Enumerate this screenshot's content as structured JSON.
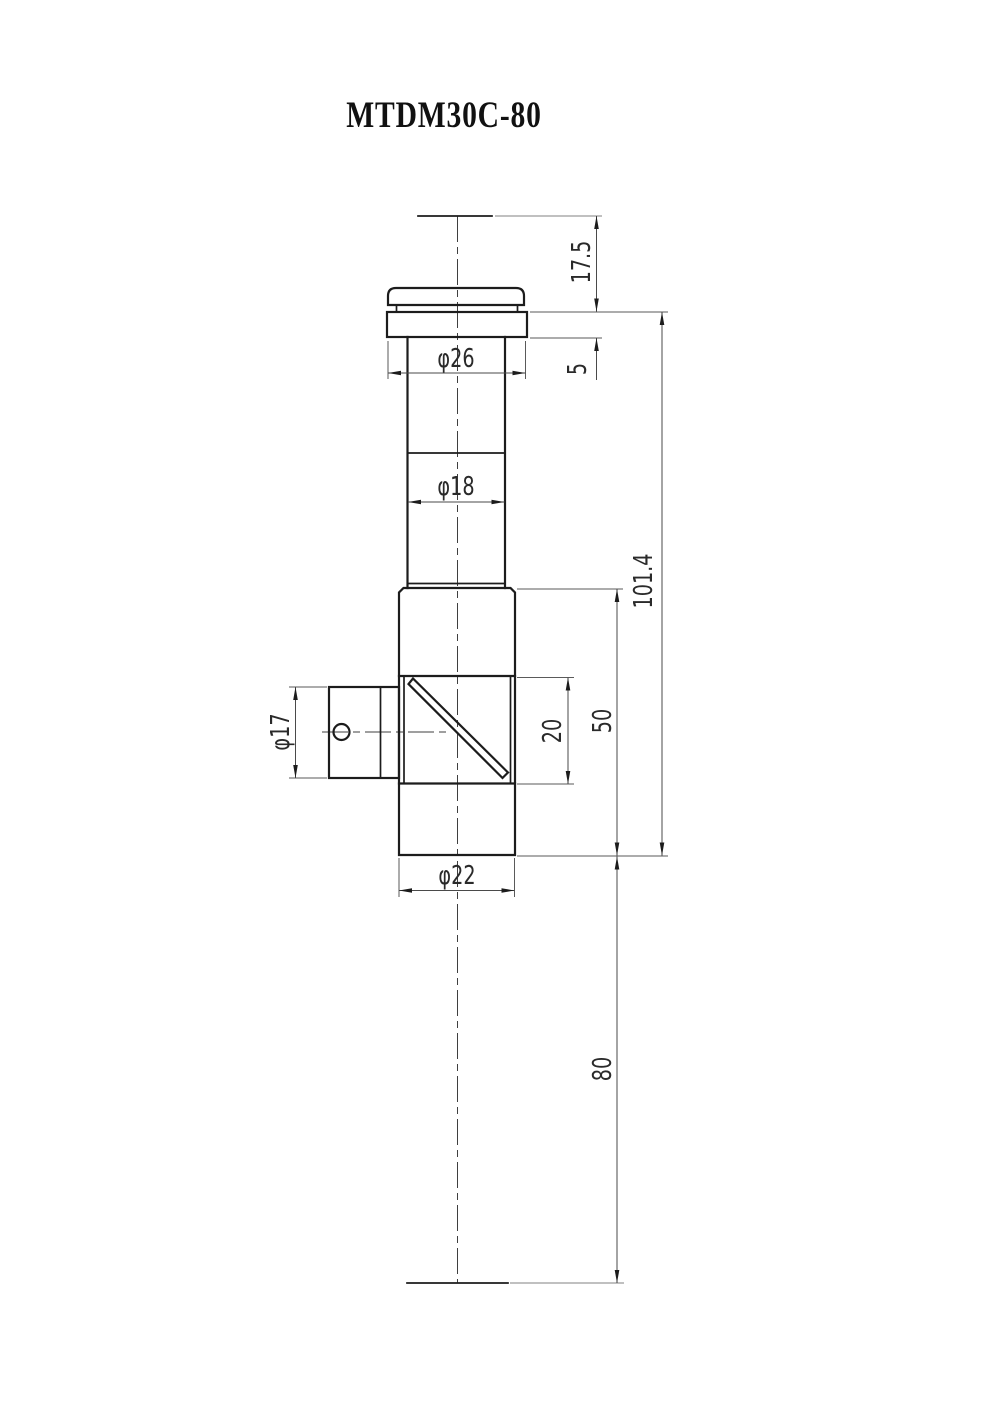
{
  "title": "MTDM30C-80",
  "drawing": {
    "kind": "engineering dimension drawing, front view",
    "dimensions": {
      "tip_height": "17.5",
      "flange_thickness": "5",
      "cap_diameter": "φ26",
      "tube_diameter": "φ18",
      "side_port_diameter": "φ17",
      "prism_window_height": "20",
      "body_height": "50",
      "total_height": "101.4",
      "body_diameter": "φ22",
      "lower_extension": "80"
    }
  }
}
